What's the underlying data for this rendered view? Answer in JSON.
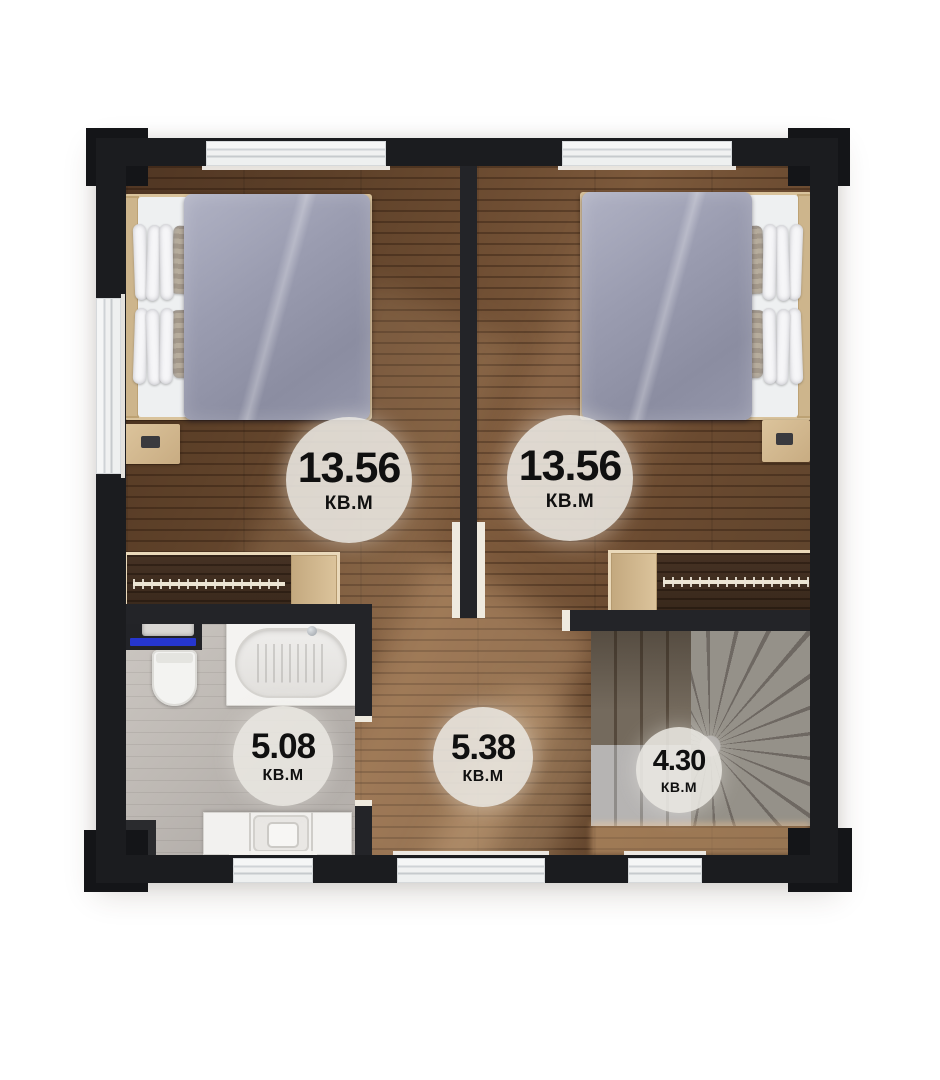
{
  "floor_plan": {
    "unit_label": "КВ.М",
    "rooms": [
      {
        "key": "bedroom_left",
        "area": "13.56",
        "unit": "КВ.М"
      },
      {
        "key": "bedroom_right",
        "area": "13.56",
        "unit": "КВ.М"
      },
      {
        "key": "bathroom",
        "area": "5.08",
        "unit": "КВ.М"
      },
      {
        "key": "hallway",
        "area": "5.38",
        "unit": "КВ.М"
      },
      {
        "key": "staircase",
        "area": "4.30",
        "unit": "КВ.М"
      }
    ],
    "colors": {
      "wall": "#1b1c1f",
      "wood_floor": "#6f4e33",
      "bathroom_floor": "#bdb8b3",
      "stair_concrete": "#8d8a87",
      "badge_background": "#ebe8e3",
      "badge_text": "#101010",
      "bed_duvet": "#9a9cb0",
      "towel_blue": "#2636cf",
      "light_wood": "#d2b88e",
      "window_white": "#f3f4f4"
    }
  }
}
